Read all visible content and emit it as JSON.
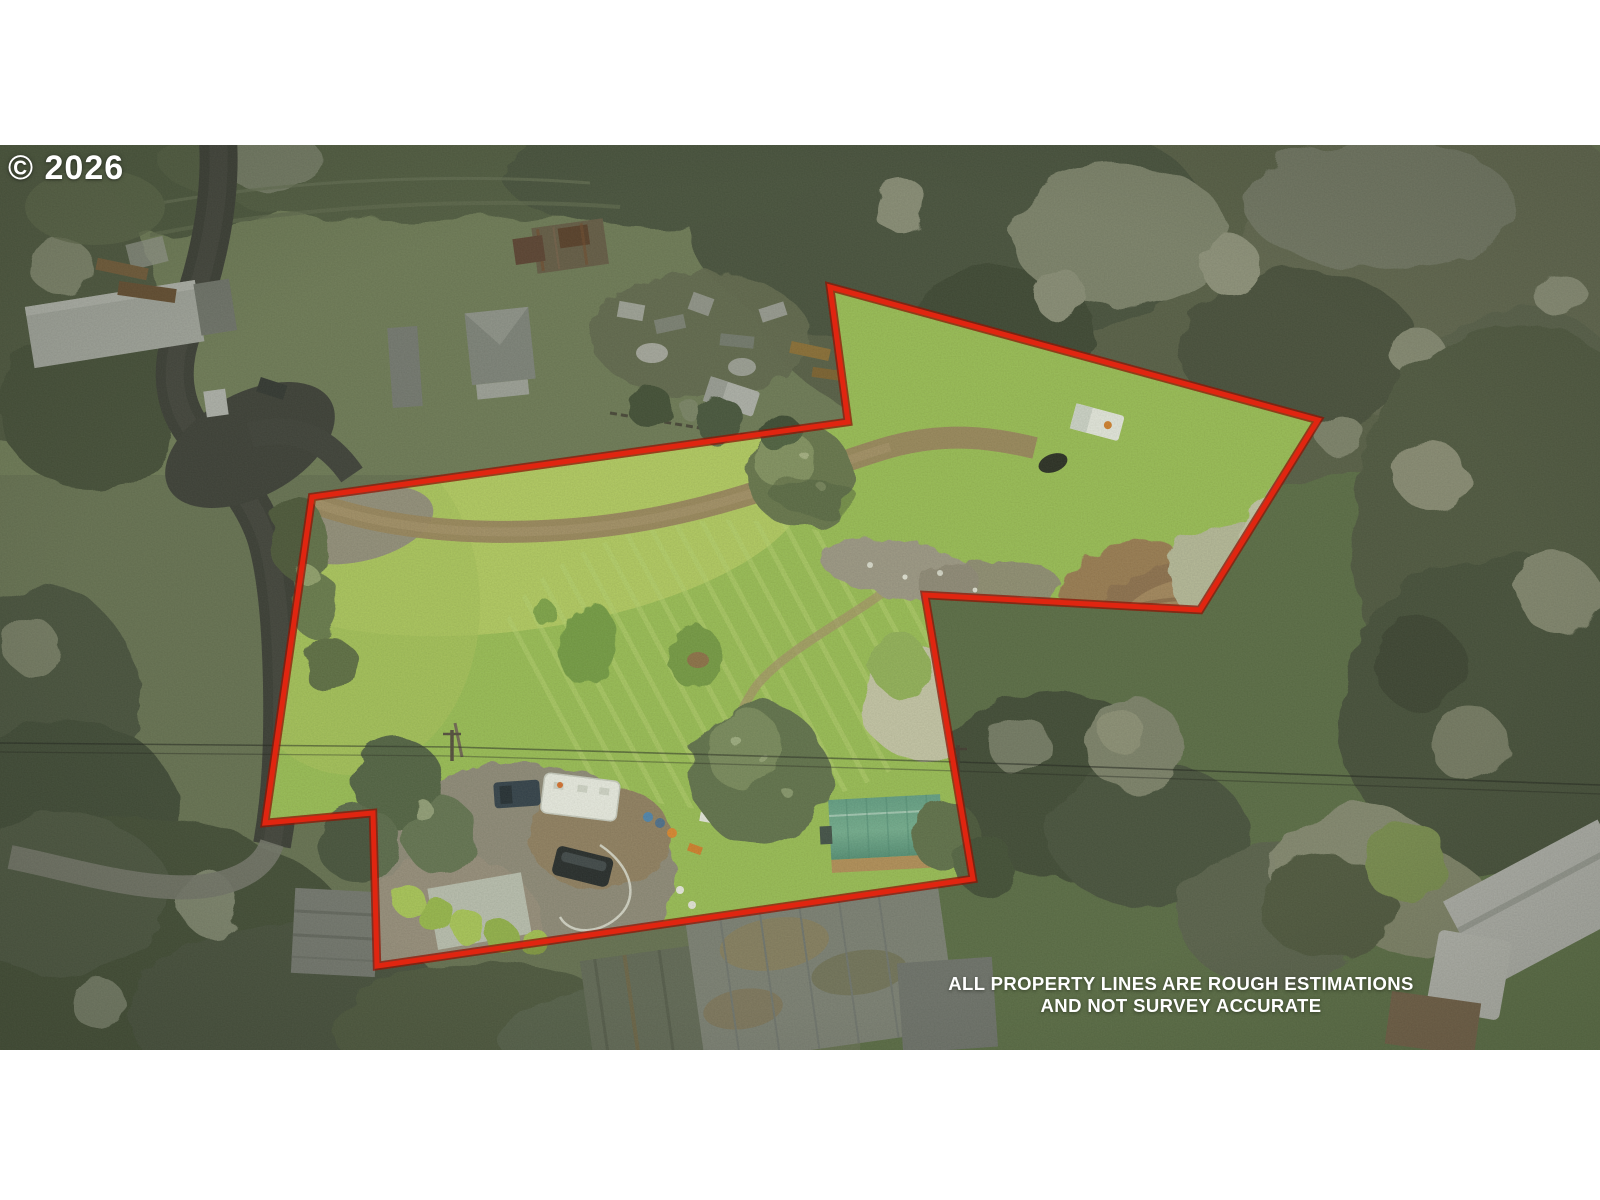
{
  "watermark": {
    "text": "© 2026"
  },
  "disclaimer": {
    "line1": "ALL PROPERTY LINES ARE ROUGH ESTIMATIONS",
    "line2": "AND NOT SURVEY ACCURATE"
  },
  "boundary": {
    "stroke_color": "#e02510",
    "edge_color": "#8c1506",
    "inner_glow": "#d8ff96",
    "points": [
      [
        830,
        142
      ],
      [
        1318,
        275
      ],
      [
        1200,
        465
      ],
      [
        925,
        450
      ],
      [
        973,
        734
      ],
      [
        377,
        821
      ],
      [
        373,
        668
      ],
      [
        265,
        678
      ],
      [
        312,
        352
      ],
      [
        848,
        277
      ]
    ]
  }
}
